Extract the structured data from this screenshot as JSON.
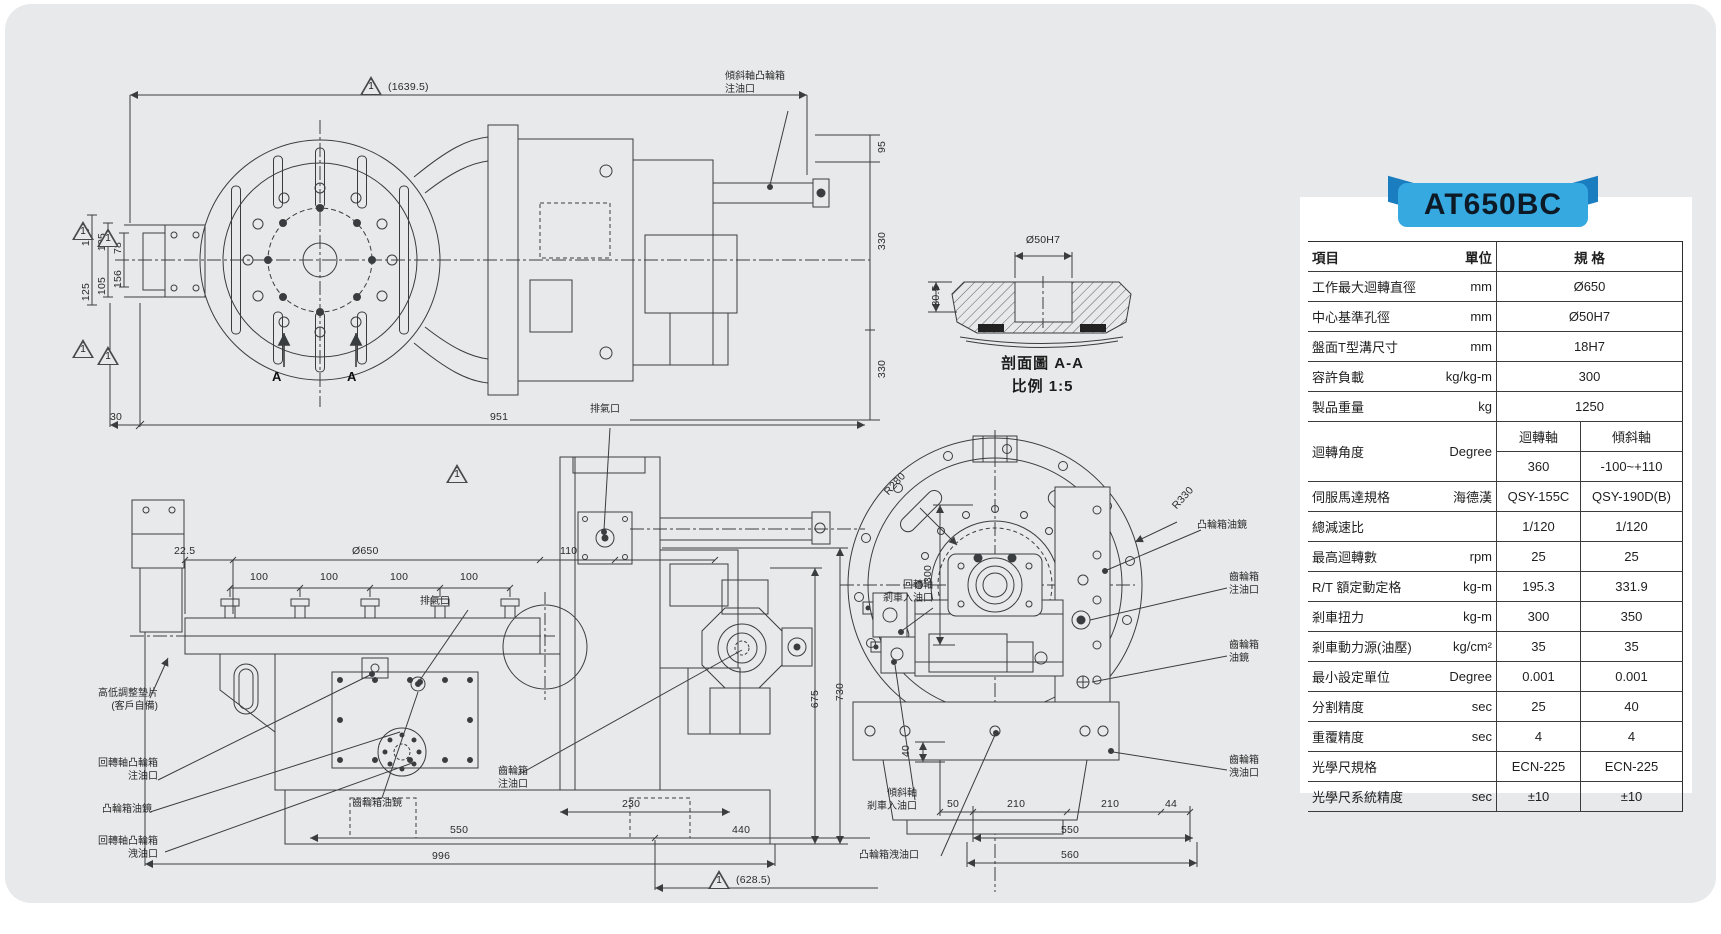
{
  "colors": {
    "accent": "#36a9e1",
    "accent_dark": "#1a7dc0",
    "sheet_background": "#e8e9ea",
    "drawing_line": "#3a3d40"
  },
  "banner": {
    "label": "AT650BC"
  },
  "table": {
    "headers": {
      "item": "項目",
      "unit": "單位",
      "spec": "規 格"
    },
    "rows": [
      {
        "item": "工作最大迴轉直徑",
        "unit": "mm",
        "value": "Ø650"
      },
      {
        "item": "中心基準孔徑",
        "unit": "mm",
        "value": "Ø50H7"
      },
      {
        "item": "盤面T型溝尺寸",
        "unit": "mm",
        "value": "18H7"
      },
      {
        "item": "容許負載",
        "unit": "kg/kg-m",
        "value": "300"
      },
      {
        "item": "製品重量",
        "unit": "kg",
        "value": "1250"
      },
      {
        "item": "迴轉角度",
        "unit": "Degree",
        "sub1": "迴轉軸",
        "sub2": "傾斜軸",
        "v1": "360",
        "v2": "-100~+110"
      },
      {
        "item": "伺服馬達規格",
        "unit": "海德漢",
        "v1": "QSY-155C",
        "v2": "QSY-190D(B)"
      },
      {
        "item": "總減速比",
        "unit": "",
        "v1": "1/120",
        "v2": "1/120"
      },
      {
        "item": "最高迴轉數",
        "unit": "rpm",
        "v1": "25",
        "v2": "25"
      },
      {
        "item": "R/T 額定動定格",
        "unit": "kg-m",
        "v1": "195.3",
        "v2": "331.9"
      },
      {
        "item": "剎車扭力",
        "unit": "kg-m",
        "v1": "300",
        "v2": "350"
      },
      {
        "item": "剎車動力源(油壓)",
        "unit": "kg/cm²",
        "v1": "35",
        "v2": "35"
      },
      {
        "item": "最小設定單位",
        "unit": "Degree",
        "v1": "0.001",
        "v2": "0.001"
      },
      {
        "item": "分割精度",
        "unit": "sec",
        "v1": "25",
        "v2": "40"
      },
      {
        "item": "重覆精度",
        "unit": "sec",
        "v1": "4",
        "v2": "4"
      },
      {
        "item": "光學尺規格",
        "unit": "",
        "v1": "ECN-225",
        "v2": "ECN-225"
      },
      {
        "item": "光學尺系統精度",
        "unit": "sec",
        "v1": "±10",
        "v2": "±10"
      }
    ]
  },
  "views": {
    "flag": "1",
    "plan": {
      "overall": "(1639.5)",
      "l1": "125",
      "l2": "105",
      "l3": "78",
      "l4": "156",
      "l5": "105",
      "l6": "125",
      "r1": "95",
      "r2": "330",
      "r3": "330",
      "b1": "30",
      "b2": "951",
      "a": "A",
      "callout_tilt_cam_fill": "傾斜軸凸輪箱\n注油口"
    },
    "section": {
      "bore": "Ø50H7",
      "depth": "30.5",
      "title": "剖面圖 A-A",
      "scale": "比例 1:5"
    },
    "side": {
      "d1": "22.5",
      "d2": "Ø650",
      "d3": "110",
      "d100": "100",
      "d230": "230",
      "d550": "550",
      "d440": "440",
      "d996": "996",
      "d628": "(628.5)",
      "d675": "675",
      "d730": "730",
      "vent": "排氣口",
      "shim": "高低調整墊片\n(客戶自備)",
      "rotary_cam_fill": "回轉軸凸輪箱\n注油口",
      "cam_sight": "凸輪箱油鏡",
      "rotary_cam_drain": "回轉軸凸輪箱\n洩油口",
      "gear_sight": "齒輪箱油鏡",
      "gear_fill": "齒輪箱\n注油口"
    },
    "front": {
      "r280": "R280",
      "r330": "R330",
      "d300": "300",
      "d40": "40",
      "d50": "50",
      "d210": "210",
      "d44": "44",
      "d550": "550",
      "d560": "560",
      "rotary_brake_in": "回轉軸\n剎車入油口",
      "tilt_brake_in": "傾斜軸\n剎車入油口",
      "cam_drain": "凸輪箱洩油口",
      "cam_sight": "凸輪箱油鏡",
      "gear_fill": "齒輪箱\n注油口",
      "gear_sight": "齒輪箱\n油鏡",
      "gear_drain": "齒輪箱\n洩油口"
    }
  }
}
